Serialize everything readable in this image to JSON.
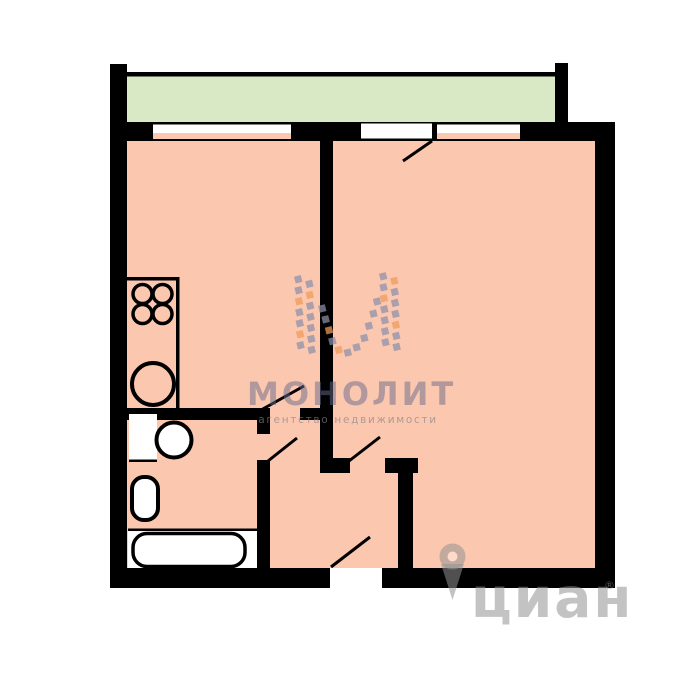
{
  "colors": {
    "floor": "#fcc7af",
    "balcony": "#d9e9c6",
    "wall": "#000000",
    "white": "#ffffff",
    "logo_gray": "#8b90a9",
    "logo_orange": "#f09b59",
    "monolit_text": "rgba(100,106,140,0.5)",
    "monolit_sub": "rgba(130,130,138,0.65)",
    "cian": "rgba(145,145,145,0.55)"
  },
  "plan": {
    "balcony": {
      "x": 125,
      "y": 76,
      "w": 430,
      "h": 46
    },
    "railing": {
      "x": 125,
      "y": 72,
      "w": 443,
      "h": 4.5
    },
    "floor": {
      "x": 127,
      "y": 141,
      "w": 468,
      "h": 427
    },
    "walls": [
      {
        "name": "left-outer-wall",
        "x": 110,
        "y": 64,
        "w": 17,
        "h": 524
      },
      {
        "name": "top-outer-wall",
        "x": 110,
        "y": 122,
        "w": 505,
        "h": 19
      },
      {
        "name": "right-outer-wall",
        "x": 595,
        "y": 122,
        "w": 20,
        "h": 466
      },
      {
        "name": "bottom-wall-left",
        "x": 110,
        "y": 568,
        "w": 220,
        "h": 20
      },
      {
        "name": "bottom-wall-right",
        "x": 382,
        "y": 568,
        "w": 233,
        "h": 20
      },
      {
        "name": "balcony-right-pillar",
        "x": 555,
        "y": 63,
        "w": 13,
        "h": 59
      },
      {
        "name": "room-divider-wall",
        "x": 320,
        "y": 140,
        "w": 13,
        "h": 333
      },
      {
        "name": "room-divider-foot",
        "x": 320,
        "y": 458,
        "w": 30,
        "h": 15
      },
      {
        "name": "kitchen-bottom-wall",
        "x": 127,
        "y": 408,
        "w": 131,
        "h": 12
      },
      {
        "name": "kitchen-door-jamb",
        "x": 300,
        "y": 408,
        "w": 33,
        "h": 12
      },
      {
        "name": "bathroom-wall-upper",
        "x": 257,
        "y": 408,
        "w": 13,
        "h": 26
      },
      {
        "name": "bathroom-wall-lower",
        "x": 257,
        "y": 460,
        "w": 13,
        "h": 108
      },
      {
        "name": "hall-door-jamb",
        "x": 385,
        "y": 458,
        "w": 33,
        "h": 15
      },
      {
        "name": "hall-right-wall",
        "x": 398,
        "y": 473,
        "w": 15,
        "h": 95
      }
    ],
    "openings": [
      {
        "name": "kitchen-window-glass",
        "x": 153,
        "y": 124.5,
        "w": 138,
        "h": 8.5,
        "fill": "white"
      },
      {
        "name": "kitchen-window-sill",
        "x": 153,
        "y": 133,
        "w": 138,
        "h": 6,
        "fill": "floor"
      },
      {
        "name": "balcony-door-opening",
        "x": 361,
        "y": 123.5,
        "w": 71,
        "h": 15,
        "fill": "white"
      },
      {
        "name": "living-window-glass",
        "x": 437,
        "y": 124.5,
        "w": 83,
        "h": 8.5,
        "fill": "white"
      },
      {
        "name": "living-window-sill",
        "x": 437,
        "y": 133,
        "w": 83,
        "h": 6,
        "fill": "floor"
      }
    ],
    "white_rects": [
      {
        "name": "sink-cabinet",
        "x": 129,
        "y": 414,
        "w": 28,
        "h": 46
      },
      {
        "name": "bathtub-area-floor",
        "x": 128,
        "y": 531,
        "w": 129,
        "h": 37
      }
    ],
    "black_bars": [
      {
        "name": "counter-top-edge",
        "x": 127,
        "y": 277,
        "w": 52,
        "h": 3.5
      },
      {
        "name": "counter-right-edge",
        "x": 176,
        "y": 277,
        "w": 3.5,
        "h": 131
      },
      {
        "name": "sink-cabinet-edge",
        "x": 129,
        "y": 459.5,
        "w": 28,
        "h": 2.5
      },
      {
        "name": "bath-area-top-edge",
        "x": 128,
        "y": 528.5,
        "w": 129,
        "h": 2.5
      }
    ],
    "circles": [
      {
        "name": "stove-burner-1",
        "cx": 142.5,
        "cy": 294,
        "r": 9.5,
        "sw": 3.5,
        "fill": "none"
      },
      {
        "name": "stove-burner-2",
        "cx": 162.5,
        "cy": 294,
        "r": 9.5,
        "sw": 3.5,
        "fill": "none"
      },
      {
        "name": "stove-burner-3",
        "cx": 142.5,
        "cy": 314,
        "r": 9.5,
        "sw": 3.5,
        "fill": "none"
      },
      {
        "name": "stove-burner-4",
        "cx": 162.5,
        "cy": 314,
        "r": 9.5,
        "sw": 3.5,
        "fill": "none"
      },
      {
        "name": "kitchen-sink",
        "cx": 153,
        "cy": 384,
        "r": 21,
        "sw": 4,
        "fill": "none"
      },
      {
        "name": "bathroom-sink",
        "cx": 174,
        "cy": 440,
        "r": 17.5,
        "sw": 4,
        "fill": "white"
      }
    ],
    "rounded_rects": [
      {
        "name": "toilet",
        "x": 132,
        "y": 477,
        "w": 26,
        "h": 43,
        "rx": 12,
        "sw": 4
      },
      {
        "name": "bathtub",
        "x": 133,
        "y": 533.5,
        "w": 112,
        "h": 33,
        "rx": 14,
        "sw": 3.5
      }
    ],
    "door_leaves": [
      {
        "name": "balcony-door-leaf",
        "x1": 432,
        "y1": 141,
        "x2": 403,
        "y2": 161
      },
      {
        "name": "kitchen-door-leaf",
        "x1": 261,
        "y1": 410,
        "x2": 304,
        "y2": 386
      },
      {
        "name": "bathroom-door-leaf",
        "x1": 268,
        "y1": 461,
        "x2": 297,
        "y2": 438
      },
      {
        "name": "living-room-door-leaf",
        "x1": 349,
        "y1": 461,
        "x2": 380,
        "y2": 437
      },
      {
        "name": "entrance-door-leaf",
        "x1": 331,
        "y1": 567,
        "x2": 370,
        "y2": 537
      }
    ]
  },
  "monolit": {
    "text": "МОНОЛИТ",
    "subtext": "агентство недвижимости",
    "squares": [
      [
        2,
        6,
        "g"
      ],
      [
        2,
        17,
        "g"
      ],
      [
        2,
        28,
        "o"
      ],
      [
        2,
        39,
        "g"
      ],
      [
        2,
        50,
        "g"
      ],
      [
        2,
        61,
        "o"
      ],
      [
        2,
        72,
        "g"
      ],
      [
        13,
        11,
        "g"
      ],
      [
        13,
        22,
        "o"
      ],
      [
        13,
        33,
        "g"
      ],
      [
        13,
        44,
        "g"
      ],
      [
        13,
        55,
        "g"
      ],
      [
        13,
        66,
        "g"
      ],
      [
        13,
        77,
        "g"
      ],
      [
        25,
        36,
        "g"
      ],
      [
        28,
        47,
        "g"
      ],
      [
        31,
        58,
        "o"
      ],
      [
        34,
        69,
        "g"
      ],
      [
        40,
        78,
        "o"
      ],
      [
        49,
        81,
        "g"
      ],
      [
        58,
        76,
        "g"
      ],
      [
        66,
        67,
        "g"
      ],
      [
        71,
        55,
        "g"
      ],
      [
        76,
        43,
        "g"
      ],
      [
        80,
        31,
        "g"
      ],
      [
        87,
        6,
        "g"
      ],
      [
        87,
        17,
        "g"
      ],
      [
        87,
        28,
        "o"
      ],
      [
        87,
        39,
        "g"
      ],
      [
        87,
        50,
        "g"
      ],
      [
        87,
        61,
        "g"
      ],
      [
        87,
        72,
        "g"
      ],
      [
        98,
        11,
        "o"
      ],
      [
        98,
        22,
        "g"
      ],
      [
        98,
        33,
        "g"
      ],
      [
        98,
        44,
        "g"
      ],
      [
        98,
        55,
        "o"
      ],
      [
        98,
        66,
        "g"
      ],
      [
        98,
        77,
        "g"
      ]
    ]
  },
  "cian": {
    "text": "циан",
    "reg": "®"
  }
}
